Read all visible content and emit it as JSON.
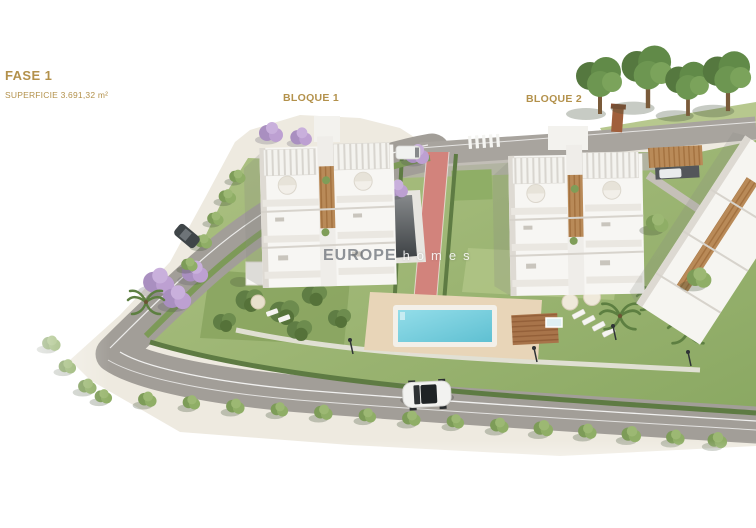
{
  "header": {
    "phase_label": "FASE 1",
    "area_label": "SUPERFICIE 3.691,32 m²",
    "label_color": "#b3914b"
  },
  "blocks": {
    "block1_label": "BLOQUE 1",
    "block2_label": "BLOQUE 2"
  },
  "watermark": {
    "brand_primary": "EUROPE",
    "brand_secondary": "homes"
  },
  "scene": {
    "type": "aerial-3d-render",
    "colors": {
      "label_gold": "#b3914b",
      "lawn_green": "#9ab56f",
      "road_gray": "#a29e98",
      "pool_blue": "#7ccfde",
      "jogging_path_pink": "#d2837c",
      "building_white": "#f7f6f3",
      "wood_brown": "#b98a58",
      "sidewalk_beige": "#eeeae0"
    },
    "objects": [
      "bloque-1-apartment-building",
      "bloque-2-apartment-building",
      "swimming-pool",
      "pool-deck",
      "jogging-path",
      "perimeter-road",
      "crosswalk",
      "street-trees",
      "jacaranda-trees",
      "palm-trees",
      "sun-loungers",
      "parasols",
      "gazebo",
      "white-car",
      "parked-dark-car",
      "white-van",
      "wooden-carport",
      "neighboring-building",
      "lawn"
    ]
  }
}
